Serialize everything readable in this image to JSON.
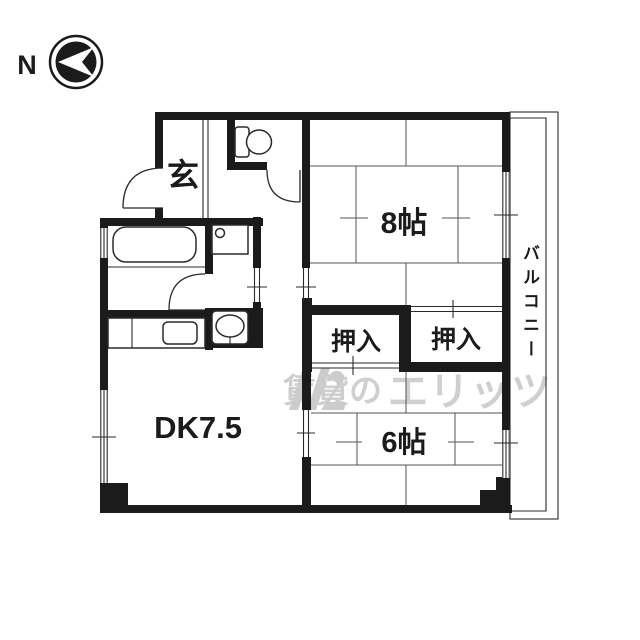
{
  "compass": {
    "north_label": "N"
  },
  "room_labels": {
    "genkan": "玄",
    "tatami_8": "8帖",
    "closet_left": "押入",
    "closet_right": "押入",
    "dining_kitchen": "DK7.5",
    "tatami_6": "6帖",
    "balcony": "バルコニー"
  },
  "watermark": {
    "prefix": "賃貸の",
    "brand": "エリッツ"
  },
  "fixtures": [
    "bathtub-icon",
    "toilet-icon",
    "washing-machine-pan-icon",
    "washbasin-icon",
    "kitchen-sink-icon",
    "entrance-door-arc",
    "toilet-door-arc",
    "bathroom-door-arc",
    "compass-icon"
  ],
  "colors": {
    "wall": "#1b1b1b",
    "line": "#2a2a2a",
    "tatami": "#555555",
    "ink": "#1b1b1b",
    "wm": "#c4c4c4",
    "bg": "#ffffff"
  }
}
